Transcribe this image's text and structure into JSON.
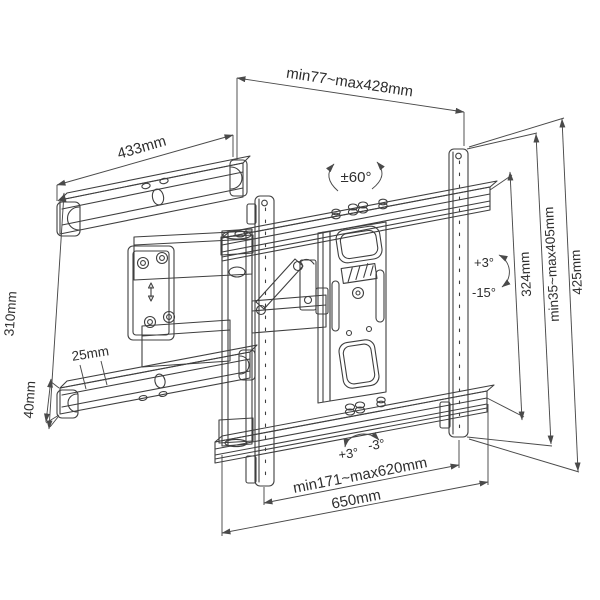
{
  "diagram": {
    "subject": "Full-motion articulating TV wall mount bracket — dimensional line drawing",
    "background": "#ffffff",
    "line_color": "#3f3f3f",
    "text_color": "#2e2e2e",
    "dims": {
      "depth_range": "min77~max428mm",
      "wall_rail_length": "433mm",
      "swivel_range": "±60°",
      "tilt_up": "+3°",
      "tilt_down": "-15°",
      "rail_spacing": "324mm",
      "vesa_height_range": "min35~max405mm",
      "bracket_height": "425mm",
      "wall_plate_height": "310mm",
      "arm_hole_offset": "25mm",
      "arm_thickness": "40mm",
      "level_plus": "+3°",
      "level_minus": "-3°",
      "vesa_width_range": "min171~max620mm",
      "bracket_width": "650mm"
    }
  }
}
